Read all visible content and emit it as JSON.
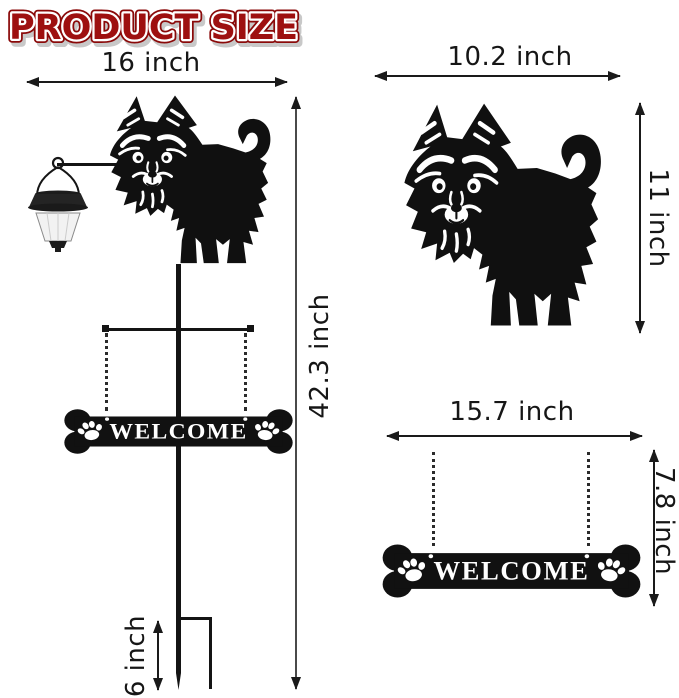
{
  "title": "PRODUCT SIZE",
  "colors": {
    "title_red": "#9E1010",
    "title_outline_red": "#8A0909",
    "dimension_line_black": "#1A1A1A",
    "silhouette_black": "#101010"
  },
  "full_stake_view": {
    "width_label": "16 inch",
    "height_label": "42.3 inch",
    "ground_stake_label": "6 inch",
    "sign_text": "WELCOME"
  },
  "dog_detail_view": {
    "width_label": "10.2 inch",
    "height_label": "11 inch"
  },
  "sign_detail_view": {
    "width_label": "15.7 inch",
    "height_label": "7.8 inch",
    "sign_text": "WELCOME"
  }
}
